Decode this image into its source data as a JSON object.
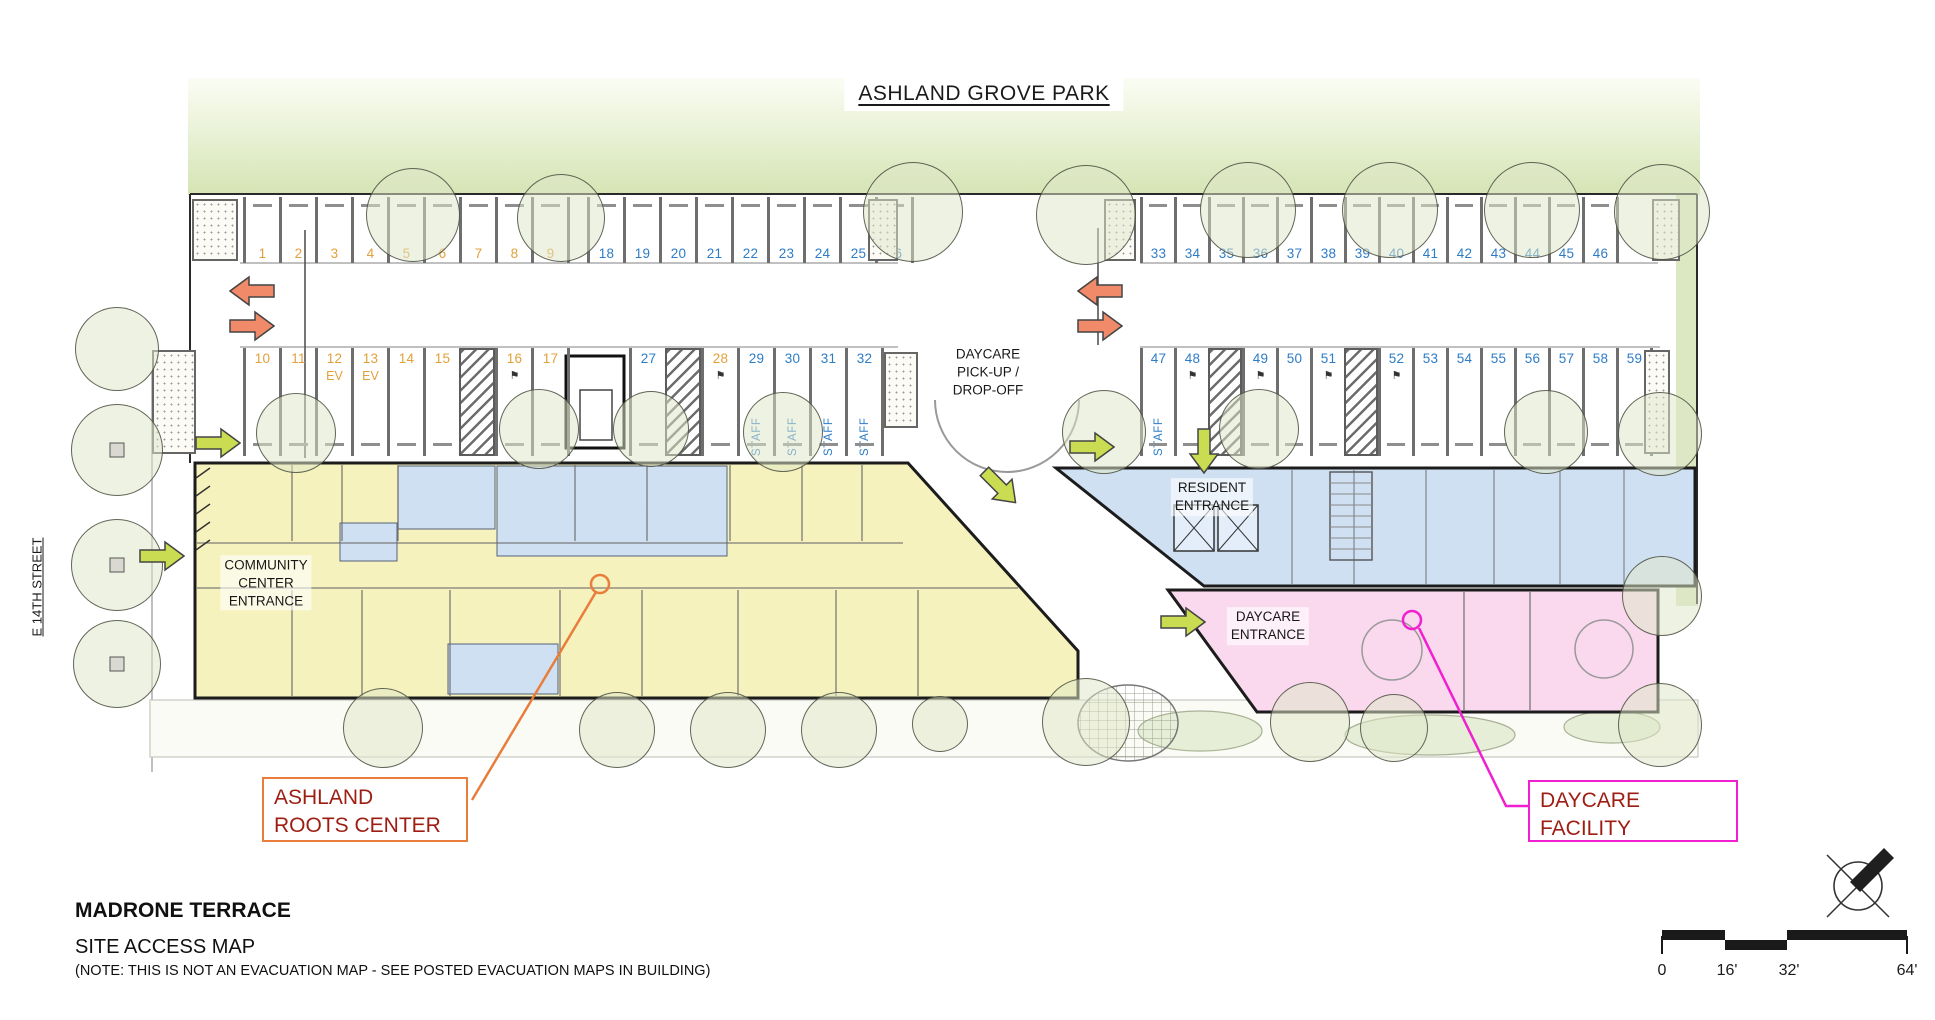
{
  "park": {
    "title": "ASHLAND GROVE PARK"
  },
  "street": {
    "name": "E 14TH STREET"
  },
  "plan_labels": {
    "daycare_pickup": "DAYCARE\nPICK-UP /\nDROP-OFF",
    "community_entrance": "COMMUNITY\nCENTER\nENTRANCE",
    "resident_entrance": "RESIDENT\nENTRANCE",
    "daycare_entrance": "DAYCARE\nENTRANCE"
  },
  "callouts": {
    "ashland_roots": {
      "label": "ASHLAND\nROOTS CENTER",
      "border_color": "#e87d3c"
    },
    "daycare_facility": {
      "label": "DAYCARE\nFACILITY",
      "border_color": "#f01fd0"
    },
    "text_color": "#9e1d12"
  },
  "title_block": {
    "project": "MADRONE TERRACE",
    "sheet": "SITE ACCESS MAP",
    "note": "(NOTE: THIS IS NOT AN EVACUATION MAP - SEE POSTED EVACUATION MAPS IN BUILDING)"
  },
  "scale_bar": {
    "labels": [
      "0",
      "16'",
      "32'",
      "64'"
    ]
  },
  "icons": {
    "accessible_marker": "⚑",
    "north_arrow": "compass with crossed lines and NE needle"
  },
  "colors": {
    "building_yellow": "#f6f2bd",
    "room_blue": "#cfe0f2",
    "daycare_pink": "#fad9ee",
    "park_green": "#d5e4b4",
    "stall_number_orange": "#e3a03a",
    "stall_number_blue": "#2d7cc7",
    "arrow_salmon": "#f08a68",
    "arrow_green": "#c9dc52",
    "callout_orange": "#e87d3c",
    "callout_magenta": "#f01fd0",
    "callout_text": "#9e1d12"
  },
  "parking": {
    "staff_label": "STAFF",
    "ev_label": "EV",
    "groups": [
      {
        "id": "row-top-left",
        "x": 243,
        "w": 36,
        "yTop": 197,
        "h": 66,
        "numAt": "bottom",
        "items": [
          {
            "n": "1",
            "c": "o"
          },
          {
            "n": "2",
            "c": "o"
          },
          {
            "n": "3",
            "c": "o"
          },
          {
            "n": "4",
            "c": "o"
          },
          {
            "n": "5",
            "c": "o"
          },
          {
            "n": "6",
            "c": "o"
          },
          {
            "n": "7",
            "c": "o"
          },
          {
            "n": "8",
            "c": "o"
          },
          {
            "n": "9",
            "c": "o"
          },
          {
            "gap": 20
          },
          {
            "n": "18",
            "c": "b"
          },
          {
            "n": "19",
            "c": "b"
          },
          {
            "n": "20",
            "c": "b"
          },
          {
            "n": "21",
            "c": "b"
          },
          {
            "n": "22",
            "c": "b"
          },
          {
            "n": "23",
            "c": "b"
          },
          {
            "n": "24",
            "c": "b"
          },
          {
            "n": "25",
            "c": "b"
          },
          {
            "n": "26",
            "c": "b"
          }
        ]
      },
      {
        "id": "row-bottom-left",
        "x": 243,
        "w": 36,
        "yTop": 348,
        "h": 108,
        "numAt": "top",
        "items": [
          {
            "n": "10",
            "c": "o"
          },
          {
            "n": "11",
            "c": "o"
          },
          {
            "n": "12",
            "c": "o",
            "sub": "EV"
          },
          {
            "n": "13",
            "c": "o",
            "sub": "EV"
          },
          {
            "n": "14",
            "c": "o"
          },
          {
            "n": "15",
            "c": "o"
          },
          {
            "hatch": 1
          },
          {
            "n": "16",
            "c": "o",
            "acc": 1
          },
          {
            "n": "17",
            "c": "o"
          },
          {
            "gap": 62
          },
          {
            "n": "27",
            "c": "b"
          },
          {
            "hatch": 1
          },
          {
            "n": "28",
            "c": "o",
            "acc": 1
          },
          {
            "n": "29",
            "c": "b",
            "staff": 1
          },
          {
            "n": "30",
            "c": "b",
            "staff": 1
          },
          {
            "n": "31",
            "c": "b",
            "staff": 1
          },
          {
            "n": "32",
            "c": "b",
            "staff": 1
          }
        ]
      },
      {
        "id": "row-top-right",
        "x": 1140,
        "w": 34,
        "yTop": 197,
        "h": 66,
        "numAt": "bottom",
        "items": [
          {
            "n": "33",
            "c": "b"
          },
          {
            "n": "34",
            "c": "b"
          },
          {
            "n": "35",
            "c": "b"
          },
          {
            "n": "36",
            "c": "b"
          },
          {
            "n": "37",
            "c": "b"
          },
          {
            "n": "38",
            "c": "b"
          },
          {
            "n": "39",
            "c": "b"
          },
          {
            "n": "40",
            "c": "b"
          },
          {
            "n": "41",
            "c": "b"
          },
          {
            "n": "42",
            "c": "b"
          },
          {
            "n": "43",
            "c": "b"
          },
          {
            "n": "44",
            "c": "b"
          },
          {
            "n": "45",
            "c": "b"
          },
          {
            "n": "46",
            "c": "b"
          }
        ]
      },
      {
        "id": "row-bottom-right",
        "x": 1140,
        "w": 34,
        "yTop": 348,
        "h": 108,
        "numAt": "top",
        "items": [
          {
            "n": "47",
            "c": "b",
            "staff": 1
          },
          {
            "n": "48",
            "c": "b",
            "acc": 1
          },
          {
            "hatch": 1
          },
          {
            "n": "49",
            "c": "b",
            "acc": 1
          },
          {
            "n": "50",
            "c": "b"
          },
          {
            "n": "51",
            "c": "b",
            "acc": 1
          },
          {
            "hatch": 1
          },
          {
            "n": "52",
            "c": "b",
            "acc": 1
          },
          {
            "n": "53",
            "c": "b"
          },
          {
            "n": "54",
            "c": "b"
          },
          {
            "n": "55",
            "c": "b"
          },
          {
            "n": "56",
            "c": "b"
          },
          {
            "n": "57",
            "c": "b"
          },
          {
            "n": "58",
            "c": "b"
          },
          {
            "n": "59",
            "c": "b"
          }
        ]
      }
    ],
    "pads": [
      [
        192,
        199,
        46,
        62
      ],
      [
        868,
        199,
        30,
        62
      ],
      [
        1104,
        199,
        32,
        62
      ],
      [
        1652,
        199,
        28,
        62
      ],
      [
        152,
        350,
        44,
        104
      ],
      [
        884,
        352,
        34,
        76
      ],
      [
        1644,
        350,
        26,
        104
      ]
    ]
  },
  "arrows": [
    {
      "x": 252,
      "y": 291,
      "dir": "left",
      "color": "salmon"
    },
    {
      "x": 252,
      "y": 326,
      "dir": "right",
      "color": "salmon"
    },
    {
      "x": 1100,
      "y": 291,
      "dir": "left",
      "color": "salmon"
    },
    {
      "x": 1100,
      "y": 326,
      "dir": "right",
      "color": "salmon"
    },
    {
      "x": 218,
      "y": 443,
      "dir": "right",
      "color": "green"
    },
    {
      "x": 162,
      "y": 556,
      "dir": "right",
      "color": "green"
    },
    {
      "x": 1092,
      "y": 447,
      "dir": "right",
      "color": "green"
    },
    {
      "x": 1204,
      "y": 451,
      "dir": "down",
      "color": "green"
    },
    {
      "x": 1000,
      "y": 487,
      "dir": "se",
      "color": "green"
    },
    {
      "x": 1183,
      "y": 622,
      "dir": "right",
      "color": "green"
    }
  ],
  "trees": [
    [
      413,
      215,
      47
    ],
    [
      561,
      218,
      44
    ],
    [
      913,
      212,
      50
    ],
    [
      1086,
      215,
      50
    ],
    [
      1248,
      210,
      48
    ],
    [
      1390,
      210,
      48
    ],
    [
      1532,
      210,
      48
    ],
    [
      1662,
      212,
      48
    ],
    [
      117,
      349,
      42
    ],
    [
      117,
      450,
      46,
      1
    ],
    [
      117,
      565,
      46,
      1
    ],
    [
      117,
      664,
      44,
      1
    ],
    [
      296,
      433,
      40
    ],
    [
      539,
      429,
      40
    ],
    [
      651,
      429,
      38
    ],
    [
      783,
      432,
      40
    ],
    [
      1104,
      432,
      42
    ],
    [
      1259,
      429,
      40
    ],
    [
      1546,
      432,
      42
    ],
    [
      1660,
      434,
      42
    ],
    [
      383,
      728,
      40
    ],
    [
      617,
      730,
      38
    ],
    [
      728,
      730,
      38
    ],
    [
      839,
      730,
      38
    ],
    [
      940,
      724,
      28
    ],
    [
      1086,
      722,
      44
    ],
    [
      1310,
      722,
      40
    ],
    [
      1394,
      728,
      34
    ],
    [
      1660,
      725,
      42
    ],
    [
      1662,
      596,
      40
    ]
  ]
}
